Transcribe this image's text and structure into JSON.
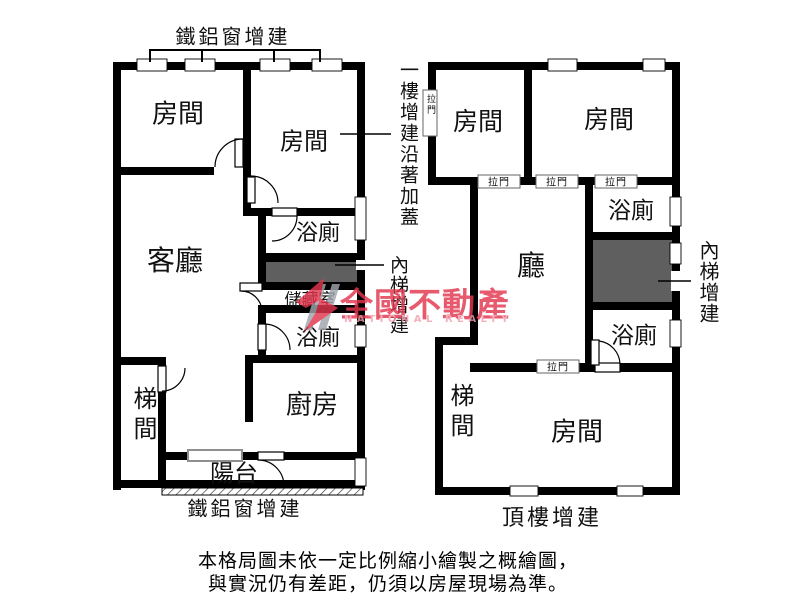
{
  "plan_left": {
    "caption_top": "鐵鋁窗增建",
    "caption_bottom": "鐵鋁窗增建",
    "rooms": {
      "room_top_left": "房間",
      "room_top_right": "房間",
      "living_room": "客廳",
      "bath_upper": "浴廁",
      "storage": "儲藏室",
      "bath_lower": "浴廁",
      "kitchen": "廚房",
      "stairwell": "梯間",
      "balcony": "陽台"
    }
  },
  "plan_right": {
    "caption_bottom": "頂樓增建",
    "sliding_door_label": "拉門",
    "rooms": {
      "room_top_left": "房間",
      "room_top_right": "房間",
      "hall": "廳",
      "bath_upper": "浴廁",
      "bath_lower": "浴廁",
      "stairwell": "梯間",
      "room_bottom": "房間"
    }
  },
  "annotations": {
    "first_floor_note": "一樓增建沿著加蓋",
    "inner_stairs_left": "內梯增建",
    "inner_stairs_right": "內梯增建"
  },
  "watermark": {
    "brand": "全國不動產",
    "brand_en": "NATIONAL REALTY",
    "brand_color": "#e2364e",
    "brand_en_color": "#f29fae"
  },
  "disclaimer": {
    "line1": "本格局圖未依一定比例縮小繪製之概繪圖，",
    "line2": "與實況仍有差距，仍須以房屋現場為準。"
  },
  "colors": {
    "wall": "#000000",
    "stairs_fill": "#5f5f5f",
    "background": "#ffffff"
  }
}
